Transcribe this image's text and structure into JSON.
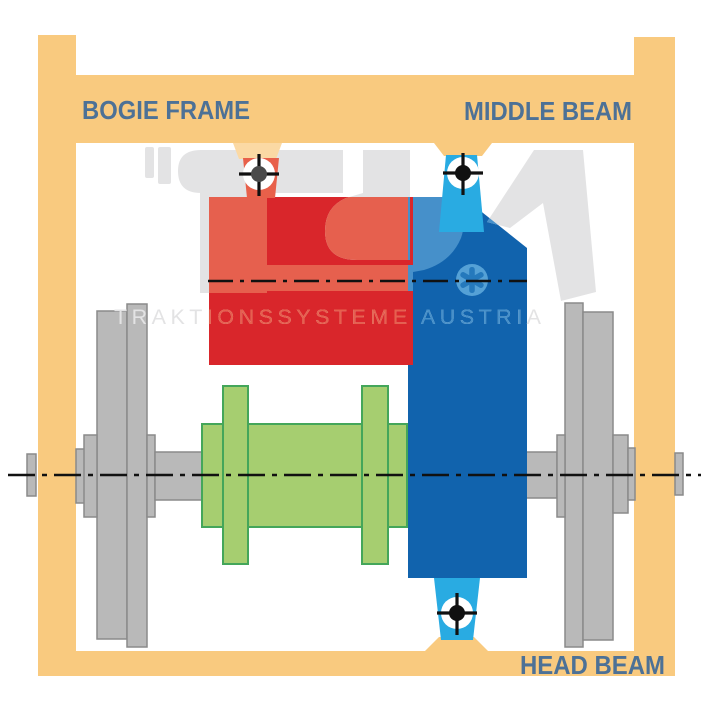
{
  "labels": {
    "bogie_frame": "BOGIE FRAME",
    "middle_beam": "MIDDLE BEAM",
    "head_beam": "HEAD BEAM"
  },
  "watermark": {
    "text": "TRAKTIONSSYSTEME AUSTRIA"
  },
  "palette": {
    "frame_orange": "#F9CA7F",
    "frame_orange_light": "#FBD9A4",
    "motor_red": "#D9262B",
    "wm_red_light": "#E6604E",
    "bracket_salmon": "#E8604A",
    "beam_blue": "#1163AD",
    "wm_blue_light": "#4690CA",
    "asterisk_circle_blue": "#55A1D6",
    "asterisk_spoke_blue": "#2579BC",
    "bracket_cyan": "#29ABE2",
    "gear_green": "#A6CE70",
    "gear_green_stroke": "#44A65A",
    "wheel_gray": "#B9B9B9",
    "wheel_gray_stroke": "#8A8A8A",
    "watermark_gray": "#E3E3E4",
    "label_blue": "#4D7196",
    "line_black": "#111111",
    "crosshair_dot_gray": "#4A4A4A"
  }
}
